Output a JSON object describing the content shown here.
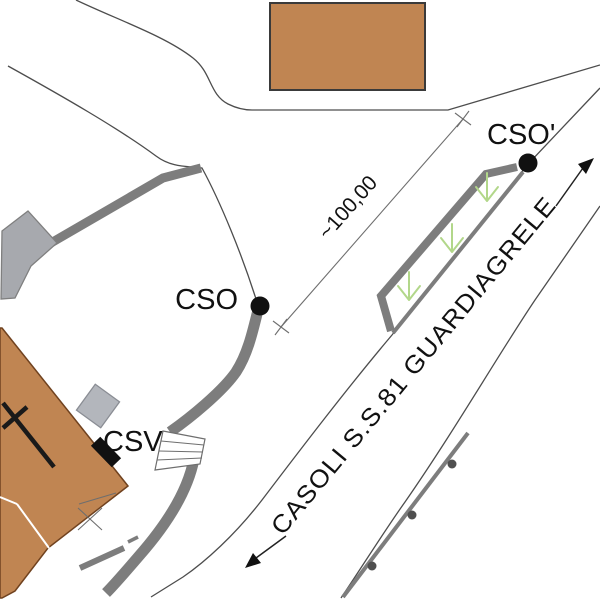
{
  "drawing": {
    "title_hint": "site plan sketch",
    "points": {
      "cso": "CSO",
      "cso_prime": "CSO'",
      "csv": "CSV"
    },
    "dimension": {
      "distance_label": "~100,00"
    },
    "road": {
      "name_label": "CASOLI S.S.81 GUARDIAGRELE",
      "direction_arrows": [
        "northeast",
        "southwest"
      ]
    },
    "colors": {
      "building_fill": "#c08552",
      "path_gray": "#7d7d7d",
      "annex_gray": "#a7a9ae",
      "outbuilding_gray": "#b3b6bc",
      "green_arrow": "#b2d78a",
      "line_black": "#111111",
      "background": "#ffffff"
    }
  }
}
